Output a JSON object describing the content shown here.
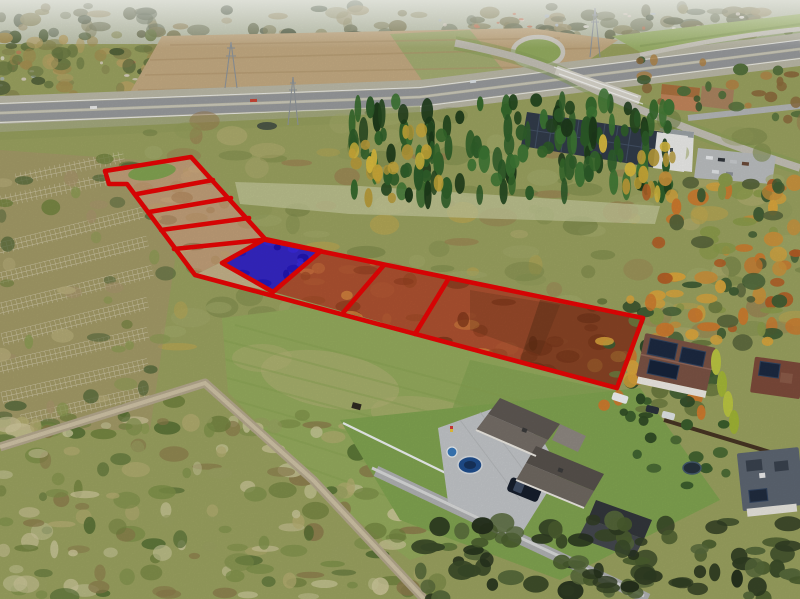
{
  "image": {
    "kind": "aerial-drone-photo",
    "description": "Autumn aerial view of building land parcels marked with red boundary lines; one parcel highlighted in solid blue. Surroundings: highway with interchange, warehouse with rooftop solar panels, conifer forest, scrubland, mowed green field, dirt road and suburban houses with solar roofs."
  },
  "overlay": {
    "outline_color": "#e60505",
    "outline_width": 4.6,
    "highlighted_parcel_fill": "#2012c9",
    "parcels_outlined_total": 8,
    "ladder_section_parcels": 5,
    "strip_section_parcels": 3,
    "highlighted_parcels": 1
  },
  "palette": {
    "sky_haze": "#d7ded9",
    "plowed_field_tan": "#c2a981",
    "forest_green": "#2c5a28",
    "scrub_olive": "#99a05f",
    "lawn_green": "#93a95c",
    "rust_parcel": "#ab5130",
    "road_gray": "#a6a8a9",
    "dirt_road": "#b3a78c",
    "solar_panel": "#1c2940"
  }
}
